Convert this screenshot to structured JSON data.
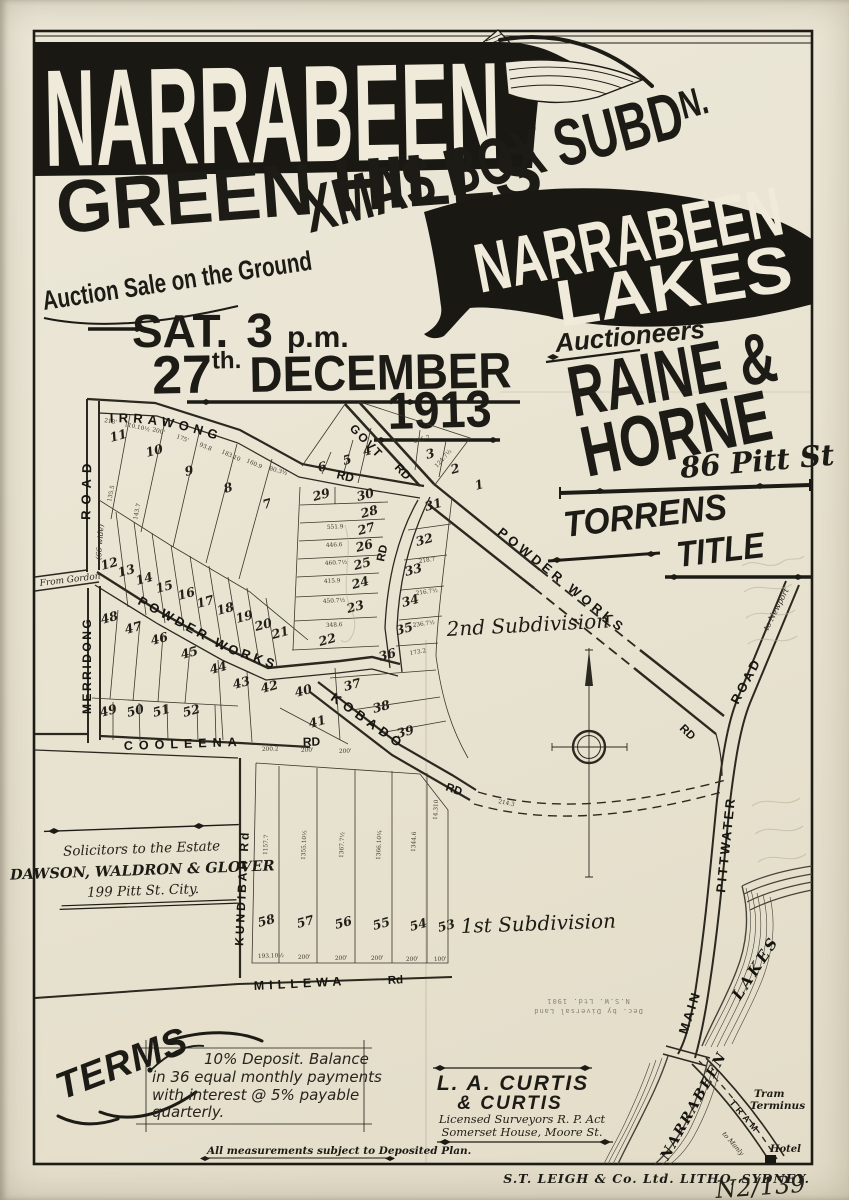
{
  "header": {
    "narrabeen": "NARRABEEN",
    "xmas_main": "XMAS BOX SUBD",
    "xmas_sup": "N.",
    "green_hills": "GREEN HILLS",
    "banner2_line1": "NARRABEEN",
    "banner2_line2": "LAKES",
    "auction_line": "Auction Sale on the Ground",
    "sat": "SAT.",
    "three": "3",
    "pm": "p.m.",
    "day": "27",
    "day_sup": "th.",
    "month": "DECEMBER",
    "year": "1913",
    "auctioneers_label": "Auctioneers",
    "auctioneer1": "RAINE &",
    "auctioneer2": "HORNE",
    "auctioneer_address": "86 Pitt St",
    "torrens": "TORRENS",
    "title_word": "TITLE"
  },
  "solicitors": {
    "heading": "Solicitors to the Estate",
    "name": "DAWSON, WALDRON & GLOVER",
    "address": "199 Pitt St. City."
  },
  "terms": {
    "heading": "TERMS",
    "line1": "10% Deposit. Balance",
    "line2": "in 36 equal monthly payments",
    "line3": "with interest @ 5% payable",
    "line4": "quarterly."
  },
  "measurements_note": "All measurements subject to Deposited Plan.",
  "surveyors": {
    "name1": "L. A. CURTIS",
    "name2": "& CURTIS",
    "line1": "Licensed Surveyors R. P. Act",
    "line2": "Somerset House, Moore St."
  },
  "imprint": "S.T. LEIGH & Co. Ltd. LITHO, SYDNEY.",
  "pencil_note": "N2/139",
  "stamp": {
    "line1": "Dec. by Diversal Land",
    "line2": "N.S.W. Ltd. 1901"
  },
  "map": {
    "roads": {
      "irrawong": "IRRAWONG",
      "powder_west": "POWDER      WORKS",
      "powder_se": "POWDER     WORKS",
      "kobado": "KOBADO",
      "kundibah": "KUNDIBAH  Rd",
      "merridong": "MERRIDONG",
      "west_road": "ROAD"
    },
    "labels": [
      {
        "t": "RD",
        "x": 336,
        "y": 478,
        "r": 14,
        "s": 12,
        "c": "road"
      },
      {
        "t": "GOVT",
        "x": 349,
        "y": 429,
        "r": 46,
        "s": 12,
        "ls": 2,
        "c": "road"
      },
      {
        "t": "RD",
        "x": 394,
        "y": 468,
        "r": 46,
        "s": 12,
        "c": "road"
      },
      {
        "t": "RD",
        "x": 384,
        "y": 562,
        "r": -78,
        "s": 11.5,
        "c": "road"
      },
      {
        "t": "RD",
        "x": 445,
        "y": 790,
        "r": 20,
        "s": 11.5,
        "c": "road"
      },
      {
        "t": "RD",
        "x": 679,
        "y": 729,
        "r": 44,
        "s": 11.5,
        "c": "road"
      },
      {
        "t": "COOLEENA",
        "x": 124,
        "y": 750,
        "r": -2,
        "s": 12.5,
        "ls": 6,
        "c": "road"
      },
      {
        "t": "RD",
        "x": 303,
        "y": 746,
        "r": -2,
        "s": 12,
        "c": "road"
      },
      {
        "t": "MILLEWA",
        "x": 254,
        "y": 990,
        "r": -3,
        "s": 12.5,
        "ls": 5,
        "c": "road"
      },
      {
        "t": "Rd",
        "x": 388,
        "y": 984,
        "r": -3,
        "s": 11.5,
        "c": "road"
      },
      {
        "t": "From Gordon",
        "x": 40,
        "y": 586,
        "r": -7,
        "s": 9,
        "c": "mapnote"
      },
      {
        "t": "(66 wide)",
        "x": 101,
        "y": 560,
        "r": -86,
        "s": 7.5,
        "c": "mapnote"
      },
      {
        "t": "2nd Subdivision",
        "x": 447,
        "y": 636,
        "r": -3,
        "s": 20,
        "c": "subdiv"
      },
      {
        "t": "1st Subdivision",
        "x": 461,
        "y": 933,
        "r": -2,
        "s": 20,
        "c": "subdiv"
      },
      {
        "t": "to Newport",
        "x": 768,
        "y": 631,
        "r": -63,
        "s": 8,
        "c": "mapnote"
      },
      {
        "t": "ROAD",
        "x": 738,
        "y": 705,
        "r": -62,
        "s": 13,
        "ls": 3,
        "c": "road"
      },
      {
        "t": "PITTWATER",
        "x": 725,
        "y": 893,
        "r": -84,
        "s": 13,
        "ls": 2.5,
        "c": "road"
      },
      {
        "t": "MAIN",
        "x": 687,
        "y": 1035,
        "r": -72,
        "s": 13,
        "ls": 3,
        "c": "road"
      },
      {
        "t": "LAKES",
        "x": 740,
        "y": 1001,
        "r": -57,
        "s": 15,
        "ls": 3,
        "c": "lake"
      },
      {
        "t": "NARRABEEN",
        "x": 668,
        "y": 1161,
        "r": -61,
        "s": 14,
        "ls": 2,
        "c": "lake"
      },
      {
        "t": "TRAM",
        "x": 729,
        "y": 1103,
        "r": 49,
        "s": 9,
        "ls": 4,
        "c": "road"
      },
      {
        "t": "to Manly",
        "x": 722,
        "y": 1134,
        "r": 49,
        "s": 6.5,
        "c": "mapnote"
      },
      {
        "t": "Tram",
        "x": 754,
        "y": 1097,
        "r": 0,
        "s": 10.5,
        "c": "mapnote2"
      },
      {
        "t": "Terminus",
        "x": 750,
        "y": 1109,
        "r": 0,
        "s": 10.5,
        "c": "mapnote2"
      },
      {
        "t": "Hotel",
        "x": 770,
        "y": 1152,
        "r": 0,
        "s": 10,
        "c": "mapnote2"
      }
    ],
    "lots": [
      [
        1,
        476,
        490
      ],
      [
        2,
        452,
        474
      ],
      [
        3,
        427,
        459
      ],
      [
        4,
        364,
        456
      ],
      [
        5,
        344,
        465
      ],
      [
        6,
        319,
        472
      ],
      [
        7,
        264,
        509
      ],
      [
        8,
        225,
        493
      ],
      [
        9,
        186,
        476
      ],
      [
        10,
        147,
        457
      ],
      [
        11,
        111,
        442
      ],
      [
        12,
        102,
        570
      ],
      [
        13,
        119,
        577
      ],
      [
        14,
        137,
        585
      ],
      [
        15,
        157,
        593
      ],
      [
        16,
        179,
        600
      ],
      [
        17,
        198,
        608
      ],
      [
        18,
        218,
        615
      ],
      [
        19,
        237,
        623
      ],
      [
        20,
        256,
        631
      ],
      [
        21,
        273,
        639
      ],
      [
        22,
        320,
        646
      ],
      [
        23,
        348,
        613
      ],
      [
        24,
        353,
        589
      ],
      [
        25,
        355,
        570
      ],
      [
        26,
        357,
        552
      ],
      [
        27,
        359,
        535
      ],
      [
        28,
        362,
        518
      ],
      [
        29,
        314,
        501
      ],
      [
        30,
        358,
        501
      ],
      [
        31,
        426,
        511
      ],
      [
        32,
        417,
        546
      ],
      [
        33,
        406,
        576
      ],
      [
        34,
        403,
        607
      ],
      [
        35,
        397,
        635
      ],
      [
        36,
        380,
        661
      ],
      [
        37,
        345,
        691
      ],
      [
        38,
        374,
        713
      ],
      [
        39,
        398,
        738
      ],
      [
        40,
        296,
        697
      ],
      [
        41,
        310,
        728
      ],
      [
        42,
        262,
        693
      ],
      [
        43,
        234,
        689
      ],
      [
        44,
        211,
        674
      ],
      [
        45,
        182,
        659
      ],
      [
        46,
        152,
        645
      ],
      [
        47,
        126,
        634
      ],
      [
        48,
        102,
        624
      ],
      [
        49,
        101,
        717
      ],
      [
        50,
        128,
        717
      ],
      [
        51,
        154,
        717
      ],
      [
        52,
        184,
        717
      ],
      [
        53,
        439,
        932
      ],
      [
        54,
        411,
        931
      ],
      [
        55,
        374,
        930
      ],
      [
        56,
        336,
        929
      ],
      [
        57,
        298,
        928
      ],
      [
        58,
        259,
        927
      ]
    ],
    "measurements": [
      [
        "213'",
        104,
        422,
        10
      ],
      [
        "110.10½",
        124,
        426,
        12
      ],
      [
        "200'",
        152,
        431,
        16
      ],
      [
        "175'",
        176,
        438,
        20
      ],
      [
        "93.8",
        199,
        446,
        22
      ],
      [
        "183.10",
        221,
        453,
        24
      ],
      [
        "160.9",
        246,
        462,
        24
      ],
      [
        "80.3½",
        269,
        470,
        16
      ],
      [
        "245.7",
        414,
        443,
        -14
      ],
      [
        "124.7½",
        437,
        468,
        -48
      ],
      [
        "551.9",
        327,
        529,
        -3
      ],
      [
        "446.6",
        326,
        547,
        -3
      ],
      [
        "460.7½",
        325,
        565,
        -3
      ],
      [
        "415.9",
        324,
        583,
        -3
      ],
      [
        "450.7½",
        323,
        603,
        -3
      ],
      [
        "348.6",
        326,
        627,
        -3
      ],
      [
        "218.7",
        419,
        563,
        -8
      ],
      [
        "216.7½",
        416,
        595,
        -8
      ],
      [
        "236.7½",
        413,
        627,
        -8
      ],
      [
        "173.2",
        410,
        655,
        -10
      ],
      [
        "214.3",
        498,
        803,
        12
      ],
      [
        "200.2",
        262,
        751,
        -2
      ],
      [
        "200'",
        301,
        752,
        -2
      ],
      [
        "200'",
        339,
        753,
        -2
      ],
      [
        "193.10½",
        258,
        958,
        -2
      ],
      [
        "200'",
        298,
        959,
        -2
      ],
      [
        "200'",
        335,
        960,
        -2
      ],
      [
        "200'",
        371,
        960,
        -2
      ],
      [
        "200'",
        406,
        961,
        -2
      ],
      [
        "100'",
        434,
        961,
        -2
      ],
      [
        "1157.7",
        267,
        855,
        -87
      ],
      [
        "1355.10½",
        305,
        860,
        -87
      ],
      [
        "1367.7½",
        343,
        858,
        -87
      ],
      [
        "1366.10¾",
        380,
        860,
        -87
      ],
      [
        "1344.6",
        415,
        852,
        -87
      ],
      [
        "14.310",
        437,
        820,
        -87
      ],
      [
        "135.5",
        111,
        502,
        -78
      ],
      [
        "143.7",
        137,
        520,
        -78
      ]
    ]
  }
}
